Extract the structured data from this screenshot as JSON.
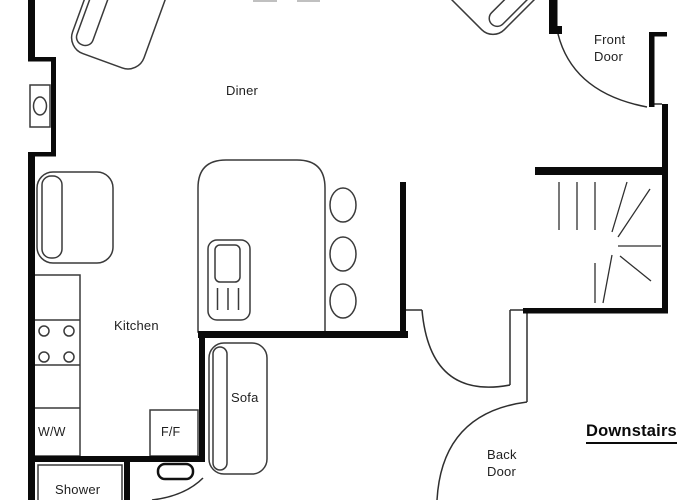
{
  "title": "Downstairs",
  "rooms": {
    "diner": "Diner",
    "kitchen": "Kitchen"
  },
  "labels": {
    "front_door": "Front Door",
    "back_door": "Back Door",
    "sofa": "Sofa",
    "shower": "Shower",
    "washing_machine": "W/W",
    "fridge_freezer": "F/F"
  },
  "icons": {
    "stairs": "winder-staircase",
    "hob_burners": 4,
    "bar_stools": 3
  },
  "colors": {
    "background": "#ffffff",
    "wall": "#0a0a0a",
    "furniture_line": "#3a3a3a",
    "text": "#1f1f1f"
  }
}
